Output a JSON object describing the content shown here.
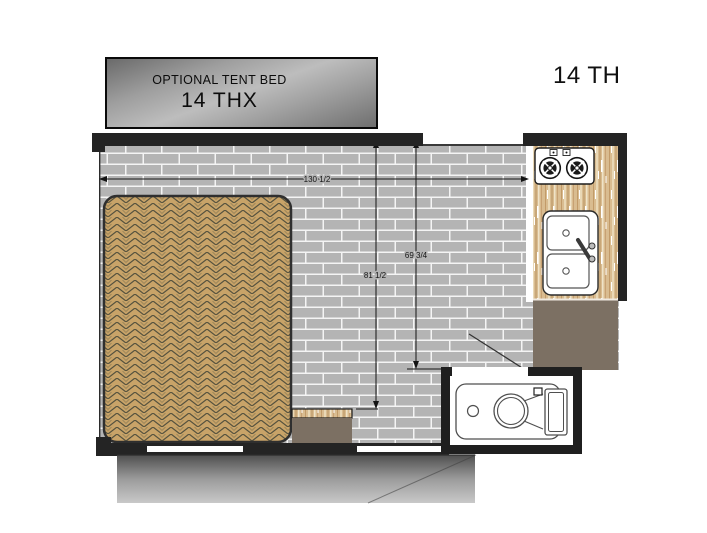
{
  "plan": {
    "model_label": "14 TH",
    "tent_bed_box": {
      "line1": "OPTIONAL TENT BED",
      "line2": "14 THX"
    },
    "dimensions": {
      "overall_width_in": "130 1/2",
      "interior_length_left_in": "81 1/2",
      "interior_length_right_in": "69 3/4"
    },
    "fixtures": {
      "bed": "mattress",
      "cooktop": "two-burner-cooktop",
      "sink": "double-basin-sink",
      "toilet": "toilet",
      "counter": "kitchen-counter",
      "cabinet_right": "cabinet",
      "cabinet_center": "cabinet",
      "bumper": "rear-bumper-step"
    },
    "colors": {
      "floor_brick": "#b4b4b4",
      "mortar": "#f4f4f4",
      "mattress_tan": "#c8a368",
      "counter_wood": "#d9bc90",
      "cabinet_taupe": "#7c7063",
      "wall_dark": "#242424"
    }
  }
}
